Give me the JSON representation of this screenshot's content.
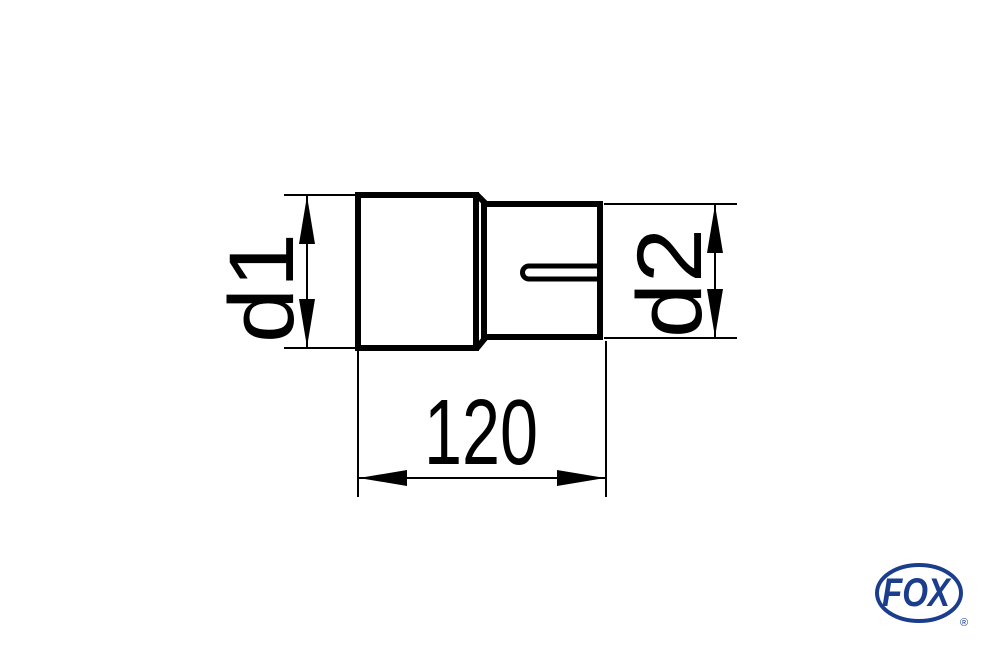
{
  "canvas": {
    "background_color": "#ffffff"
  },
  "drawing": {
    "stroke_color": "#000000",
    "dimensions": {
      "d1_label": "d1",
      "d2_label": "d2",
      "length_label": "120"
    }
  },
  "logo": {
    "text": "FOX",
    "registered": "®",
    "color": "#1b3d8e"
  }
}
